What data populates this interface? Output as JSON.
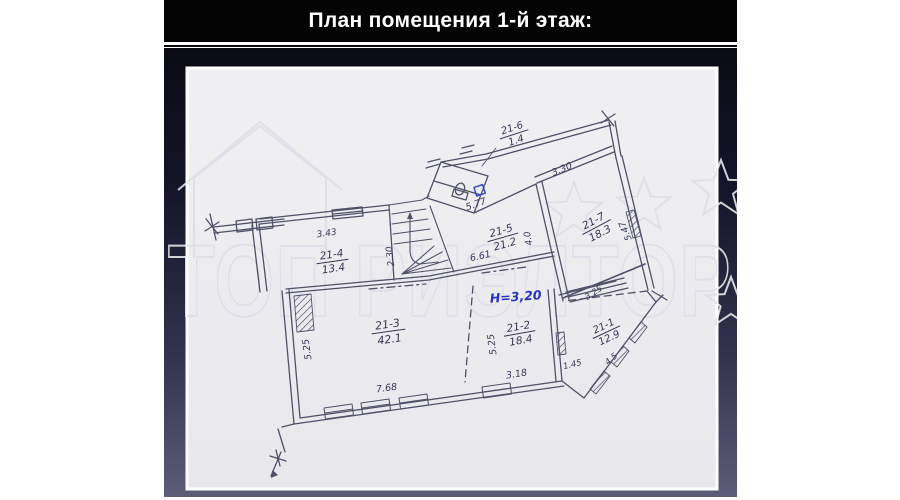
{
  "slide": {
    "title": "План помещения 1-й этаж:"
  },
  "watermark": {
    "text": "ТОП РИЭЛТОР"
  },
  "plan": {
    "height_note": "Н=3,20",
    "rooms": {
      "r21_1": {
        "code": "21-1",
        "area": "12.9"
      },
      "r21_2": {
        "code": "21-2",
        "area": "18.4"
      },
      "r21_3": {
        "code": "21-3",
        "area": "42.1"
      },
      "r21_4": {
        "code": "21-4",
        "area": "13.4"
      },
      "r21_5": {
        "code": "21-5",
        "area": "21.2"
      },
      "r21_6": {
        "code": "21-6",
        "area": "1.4"
      },
      "r21_7": {
        "code": "21-7",
        "area": "18.3"
      }
    },
    "dims": {
      "w343": "3.43",
      "w230": "2.30",
      "w577": "5.77",
      "w661": "6.61",
      "w330": "3.30",
      "w525a": "5.25",
      "w525b": "5.25",
      "w40": "4.0",
      "w768": "7.68",
      "w318": "3.18",
      "w145": "1.45",
      "w45": "4.5",
      "w325": "3.25",
      "w547": "5.47"
    }
  },
  "colors": {
    "ink": "#3b3b55",
    "blue_ink": "#2433c0",
    "slide_bottom": "#5d5d78"
  }
}
